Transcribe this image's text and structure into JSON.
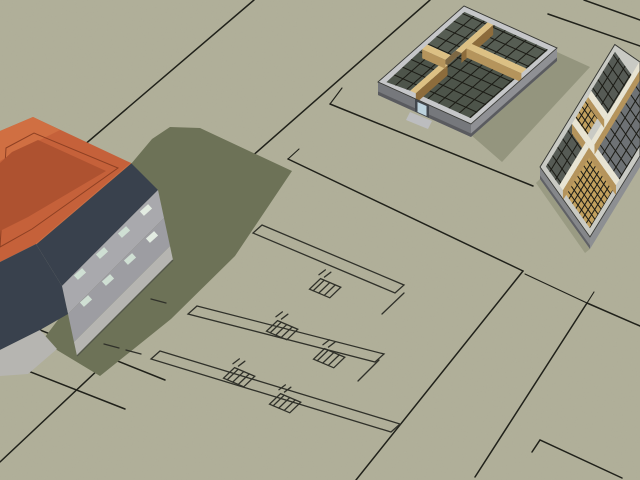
{
  "scene": {
    "viewport": "3d-architectural-model-viewport",
    "objects": {
      "house": "hip-roof house massing model",
      "house_shadow": "cast shadow of house",
      "floorplan_model_a": "open-top floor framing model",
      "floorplan_model_b": "open-top floor framing model partially visible at right edge",
      "sketch_plan": "2d floor plan sketch drawn on ground",
      "lot_lines": "site and lot boundary sketch lines",
      "ground": "terrain plane"
    }
  },
  "colors": {
    "ground": "#b1b09a",
    "shadow": "#6d7257",
    "line_dark": "#20211a",
    "sketch_line": "#30312a",
    "grid": "#1b1b15",
    "roof_orange": "#c5613a",
    "roof_orange_inner": "#ae5230",
    "roof_orange_bright": "#d06f42",
    "roof_ridge": "#8e4023",
    "fascia": "#39414d",
    "wall_upper": "#a9a9ad",
    "wall_lower": "#9d9da2",
    "wall_base": "#b6b5b1",
    "window": "#cfdfd3",
    "window_bright": "#e2ebe1",
    "m1_band": "#c6c7c9",
    "m1_face_se": "#8f9094",
    "m1_face_sw": "#76787c",
    "m1_face_base": "#5a5b5f",
    "tan_top": "#dcc084",
    "tan_face": "#b5945c",
    "tan_face_dark": "#8d6c3c",
    "floor_dark": "#4d544a",
    "floor_mid": "#565d53",
    "floor_tan": "#c2a05e",
    "hall_floor": "#7d6844",
    "door_recess": "#42474d",
    "door_glass": "#bdd3de",
    "step": "#bcbdbf",
    "m2_cap": "#e8e4d3",
    "m2_band": "#c9cac4",
    "m2_face": "#85878a",
    "m2_face2": "#8d8f92",
    "m2_face_base": "#606165",
    "m2_floor_gray": "#6e7275",
    "m2_floor_dark": "#565b55"
  }
}
